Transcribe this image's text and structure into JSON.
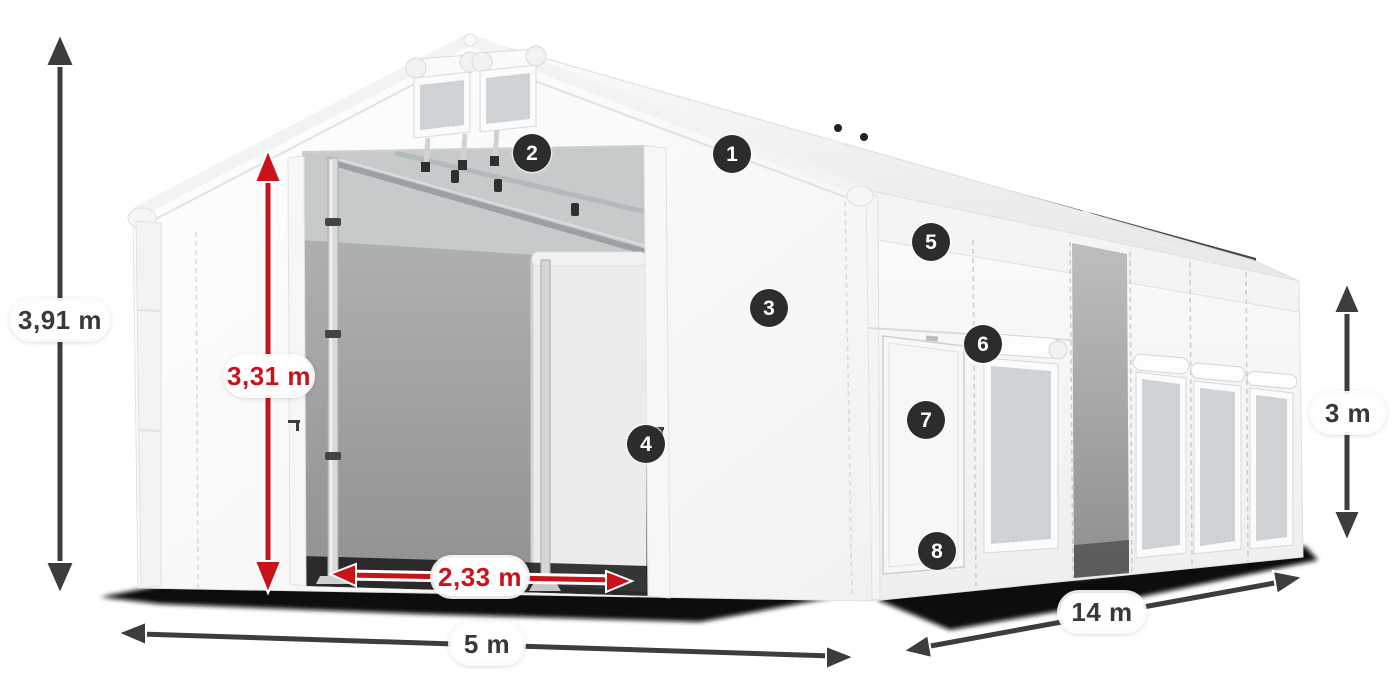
{
  "colors": {
    "dimension_dark": "#3d3d3d",
    "dimension_red": "#c9121a",
    "pill_background": "#ffffff",
    "badge_background": "#2c2c2c",
    "badge_text": "#ffffff",
    "tent_white": "#f8f8f8",
    "interior_gray": "#a2a4a5",
    "ground_shadow": "#0b0b0b"
  },
  "dimensions": [
    {
      "id": "total-height",
      "label": "3,91 m",
      "color": "#3d3d3d"
    },
    {
      "id": "entrance-height",
      "label": "3,31 m",
      "color": "#c9121a"
    },
    {
      "id": "entrance-width",
      "label": "2,33 m",
      "color": "#c9121a"
    },
    {
      "id": "front-width",
      "label": "5 m",
      "color": "#3d3d3d"
    },
    {
      "id": "side-length",
      "label": "14 m",
      "color": "#3d3d3d"
    },
    {
      "id": "side-height",
      "label": "3 m",
      "color": "#3d3d3d"
    }
  ],
  "callouts": [
    {
      "number": "1"
    },
    {
      "number": "2"
    },
    {
      "number": "3"
    },
    {
      "number": "4"
    },
    {
      "number": "5"
    },
    {
      "number": "6"
    },
    {
      "number": "7"
    },
    {
      "number": "8"
    }
  ]
}
